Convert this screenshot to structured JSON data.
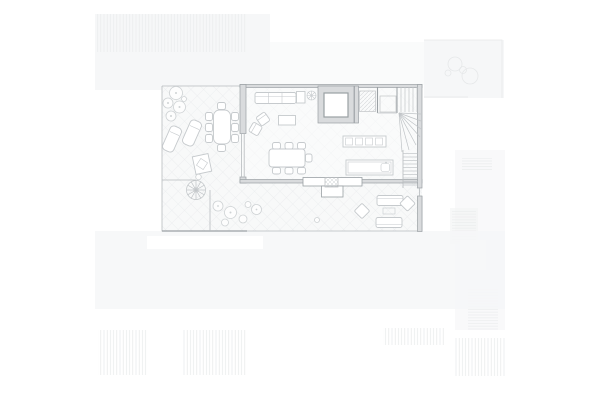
{
  "scene": {
    "kind": "architectural floor plan drawing",
    "description": "Ground-floor plan of a house with an L-shaped diamond-tiled terrace wrapping the left and bottom sides, drawn in light gray linework on white. Faint outlines of neighbouring roofs with hatching surround the plan.",
    "visible_text": []
  },
  "palette": {
    "bg": "#ffffff",
    "context_fill": "#f6f7f8",
    "context_fill_2": "#f2f3f4",
    "context_line": "#e6e8e9",
    "terrace_fill": "#f8f9f9",
    "plan_fill": "#fafbfb",
    "tile_line": "#e8eaec",
    "wall_stroke": "#9aa0a4",
    "wall_fill": "#d9dbdd",
    "thin_line": "#b7bbbe",
    "furniture_stroke": "#c6cacd",
    "furniture_fill": "#ffffff",
    "stair_line": "#c0c4c7",
    "plant_stroke": "#ced2d4"
  },
  "rooms": [
    "wrap-around terrace with diamond tile paving",
    "living area",
    "dining area",
    "kitchen",
    "stair hall",
    "entry porch",
    "skylight / light-well box"
  ],
  "objects": {
    "indoor": [
      "sofa with side table",
      "two angled armchairs",
      "coffee table",
      "potted plant",
      "dining table with seven chairs",
      "kitchen wall counter with four cabinet squares",
      "kitchen island with sink",
      "winder staircase (top right)",
      "straight stair run along right wall",
      "hatched service shaft"
    ],
    "outdoor": [
      "terrace dining table with eight chairs",
      "two chaise longues",
      "tree cluster top-left",
      "planter / grill stand",
      "spiral staircase",
      "shrub cluster along bottom terrace",
      "outdoor lounge with two sofas, low table and two angled chairs",
      "entry step with hatched mat"
    ]
  },
  "context_features": [
    "neighbouring roof with vertical hatching (top-left)",
    "neighbouring terrace with faint plants (top-right)",
    "neighbouring roofs with hatching (bottom edge and right side)"
  ]
}
